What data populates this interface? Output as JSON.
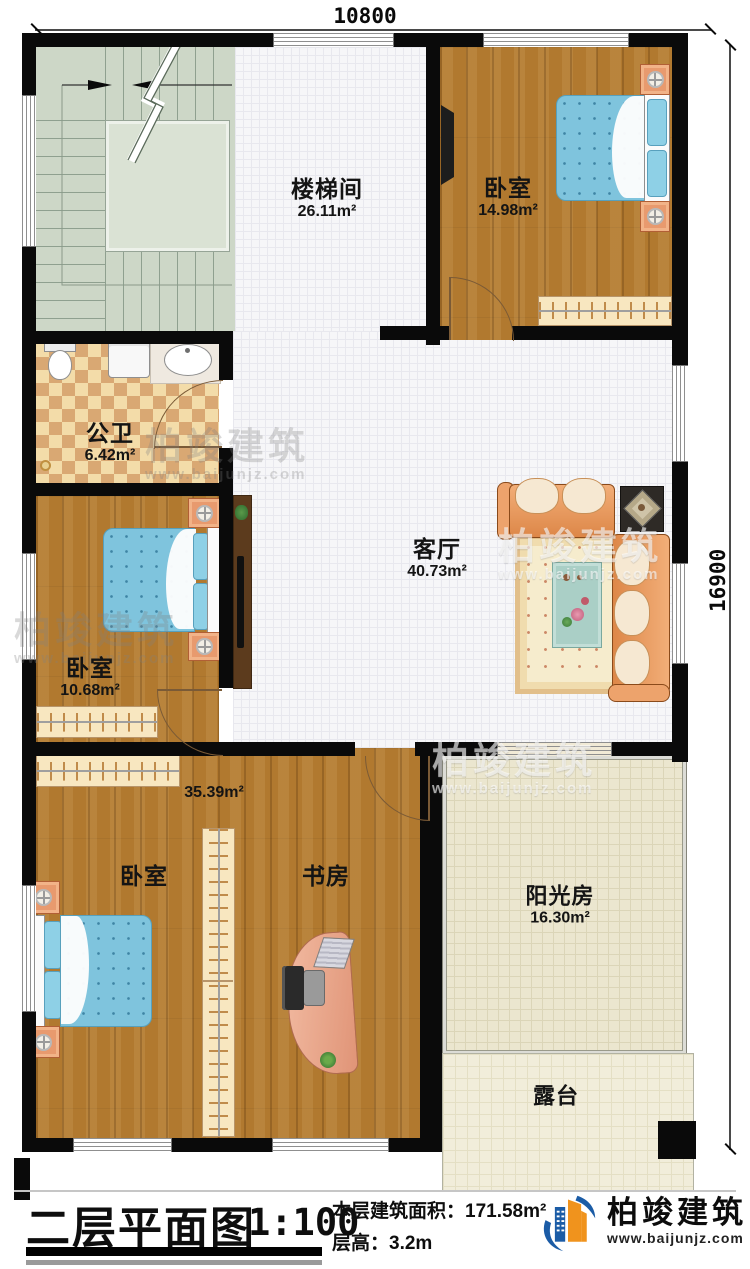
{
  "dimensions": {
    "width": "10800",
    "height": "16900"
  },
  "rooms": {
    "stairwell": {
      "name": "楼梯间",
      "area": "26.11m²"
    },
    "bedroom_top": {
      "name": "卧室",
      "area": "14.98m²"
    },
    "bathroom": {
      "name": "公卫",
      "area": "6.42m²"
    },
    "living_room": {
      "name": "客厅",
      "area": "40.73m²"
    },
    "bedroom_mid": {
      "name": "卧室",
      "area": "10.68m²"
    },
    "bedroom_bottom": {
      "name": "卧室",
      "area": "35.39m²"
    },
    "study": {
      "name": "书房"
    },
    "sunroom": {
      "name": "阳光房",
      "area": "16.30m²"
    },
    "terrace": {
      "name": "露台"
    }
  },
  "title_block": {
    "title": "二层平面图",
    "scale": "1:100",
    "floor_area": "本层建筑面积：171.58m²",
    "floor_height": "层高：3.2m",
    "brand": "柏竣建筑",
    "website": "www.baijunjz.com"
  },
  "watermark": {
    "brand": "柏竣建筑",
    "website": "www.baijunjz.com"
  },
  "colors": {
    "wall": "#0a0a0a",
    "wood_floor": "#b1792f",
    "tile_floor": "#f6f6f8",
    "stair_floor": "#cdd7c7",
    "bath_tile": "#eecb92",
    "sunroom_floor": "#ebe6cf",
    "bed_blue": "#7fc4dd",
    "sofa_orange": "#eda36c",
    "logo_blue": "#1b5ca6",
    "logo_orange": "#f0931d"
  }
}
